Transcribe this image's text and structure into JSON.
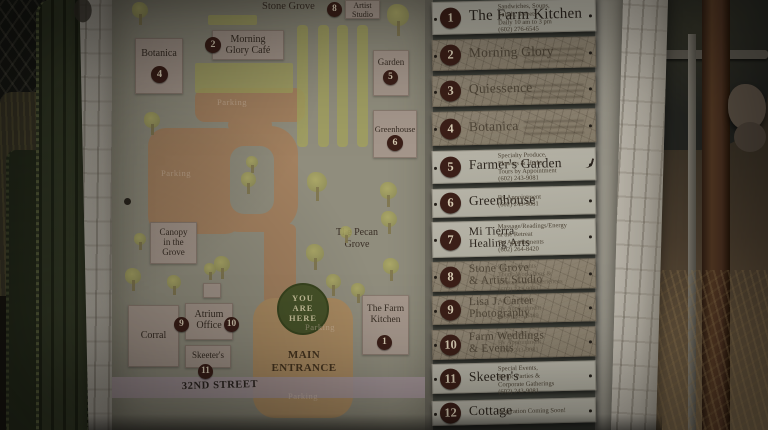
{
  "palette": {
    "badge_brown": "#3b1f18",
    "you_are_here_green": "#475329",
    "road_tan": "#a2805f",
    "entrance_tan": "#a98a61",
    "tree_olive": "#9e9b5c",
    "street_pink": "#a5949a",
    "label_pink": "#a4968b"
  },
  "map": {
    "street_label": "32ND STREET",
    "main_entrance_label": "MAIN ENTRANCE",
    "you_are_here_label": "YOU ARE HERE",
    "stone_grove_label": "Stone Grove",
    "pecan_grove_label": "The Pecan Grove",
    "parking_text": "Parking",
    "parking_labels": [
      {
        "x": 100,
        "y": 97,
        "w": 40
      },
      {
        "x": 44,
        "y": 168,
        "w": 40
      },
      {
        "x": 186,
        "y": 322,
        "w": 44
      },
      {
        "x": 168,
        "y": 391,
        "w": 46
      }
    ],
    "boxes": [
      {
        "id": "artist-studio",
        "lines": [
          "Artist",
          "Studio"
        ],
        "x": 233,
        "y": 0,
        "w": 35,
        "h": 19,
        "fs": 8,
        "pt": 1
      },
      {
        "id": "morning-glory-cafe",
        "lines": [
          "Morning",
          "Glory Café"
        ],
        "x": 100,
        "y": 30,
        "w": 72,
        "h": 30,
        "fs": 10,
        "pt": 3
      },
      {
        "id": "botanica",
        "lines": [
          "Botanica"
        ],
        "x": 23,
        "y": 38,
        "w": 48,
        "h": 56,
        "fs": 10,
        "pt": 9
      },
      {
        "id": "garden",
        "lines": [
          "Garden"
        ],
        "x": 261,
        "y": 50,
        "w": 36,
        "h": 46,
        "fs": 9,
        "pt": 6
      },
      {
        "id": "greenhouse",
        "lines": [
          "Greenhouse"
        ],
        "x": 261,
        "y": 110,
        "w": 44,
        "h": 48,
        "fs": 8.5,
        "pt": 14
      },
      {
        "id": "canopy-in-the-grove",
        "lines": [
          "Canopy",
          "in the",
          "Grove"
        ],
        "x": 38,
        "y": 222,
        "w": 47,
        "h": 42,
        "fs": 9,
        "pt": 4
      },
      {
        "id": "corral",
        "lines": [
          "Corral"
        ],
        "x": 16,
        "y": 305,
        "w": 51,
        "h": 62,
        "fs": 10,
        "pt": 24
      },
      {
        "id": "atrium-office",
        "lines": [
          "Atrium",
          "Office"
        ],
        "x": 73,
        "y": 303,
        "w": 48,
        "h": 37,
        "fs": 10,
        "pt": 5
      },
      {
        "id": "skeeters",
        "lines": [
          "Skeeter's"
        ],
        "x": 73,
        "y": 345,
        "w": 46,
        "h": 23,
        "fs": 9,
        "pt": 4
      },
      {
        "id": "farm-kitchen",
        "lines": [
          "The Farm",
          "Kitchen"
        ],
        "x": 250,
        "y": 295,
        "w": 47,
        "h": 60,
        "fs": 9.5,
        "pt": 8
      },
      {
        "id": "small-structure",
        "lines": [],
        "x": 91,
        "y": 283,
        "w": 18,
        "h": 15,
        "fs": 8,
        "pt": 0
      }
    ],
    "badges": [
      {
        "n": "8",
        "x": 215,
        "y": 2,
        "d": 15
      },
      {
        "n": "2",
        "x": 93,
        "y": 37,
        "d": 16
      },
      {
        "n": "4",
        "x": 39,
        "y": 66,
        "d": 17
      },
      {
        "n": "5",
        "x": 271,
        "y": 70,
        "d": 15
      },
      {
        "n": "6",
        "x": 275,
        "y": 135,
        "d": 16
      },
      {
        "n": "9",
        "x": 62,
        "y": 317,
        "d": 15
      },
      {
        "n": "10",
        "x": 112,
        "y": 317,
        "d": 15
      },
      {
        "n": "11",
        "x": 86,
        "y": 364,
        "d": 15
      },
      {
        "n": "1",
        "x": 265,
        "y": 335,
        "d": 15
      }
    ],
    "garden_rows": [
      185,
      206,
      225,
      245
    ],
    "olive_bars": [
      [
        96,
        15,
        49,
        10
      ],
      [
        83,
        63,
        98,
        30
      ]
    ],
    "trees": [
      [
        28,
        2,
        16
      ],
      [
        286,
        4,
        22
      ],
      [
        40,
        112,
        16
      ],
      [
        140,
        156,
        12
      ],
      [
        136,
        172,
        15
      ],
      [
        205,
        172,
        20
      ],
      [
        276,
        182,
        17
      ],
      [
        277,
        211,
        16
      ],
      [
        28,
        233,
        12
      ],
      [
        234,
        226,
        12
      ],
      [
        203,
        244,
        18
      ],
      [
        279,
        258,
        16
      ],
      [
        110,
        256,
        16
      ],
      [
        21,
        268,
        16
      ],
      [
        62,
        275,
        14
      ],
      [
        98,
        263,
        12
      ],
      [
        221,
        274,
        15
      ],
      [
        246,
        283,
        14
      ]
    ]
  },
  "directory": {
    "items": [
      {
        "number": "1",
        "name_lines": [
          "The Farm Kitchen"
        ],
        "weathered": false,
        "top": 2,
        "h": 33,
        "details": [
          "Sandwiches, Soups,",
          "Salads, Sweets",
          "Daily 10 am to 3 pm",
          "(602) 276-6545"
        ],
        "faint": false
      },
      {
        "number": "2",
        "name_lines": [
          "Morning Glory"
        ],
        "weathered": true,
        "top": 40,
        "h": 31,
        "details": [],
        "faint": true
      },
      {
        "number": "3",
        "name_lines": [
          "Quiessence"
        ],
        "weathered": true,
        "top": 76,
        "h": 31,
        "details": [],
        "faint": true
      },
      {
        "number": "4",
        "name_lines": [
          "Botanica"
        ],
        "weathered": true,
        "top": 112,
        "h": 34,
        "details": [],
        "faint": true
      },
      {
        "number": "5",
        "name_lines": [
          "Farmer's Garden"
        ],
        "weathered": false,
        "top": 151,
        "h": 33,
        "details": [
          "Specialty Produce,",
          "Flowers & Herbs",
          "Tours by Appointment",
          "(602) 243-9081"
        ],
        "faint": false,
        "mark": true
      },
      {
        "number": "6",
        "name_lines": [
          "Greenhouse"
        ],
        "weathered": false,
        "top": 189,
        "h": 29,
        "details": [
          "By Appointment",
          "(602) 243-9081"
        ],
        "faint": false
      },
      {
        "number": "7",
        "name_lines": [
          "Mi Tierra",
          "Healing Arts"
        ],
        "weathered": false,
        "top": 222,
        "h": 36,
        "details": [
          "Massage/Readings/Energy",
          "at the Retreat",
          "By Appointments",
          "(602) 264-8420"
        ],
        "faint": false
      },
      {
        "number": "8",
        "name_lines": [
          "Stone Grove",
          "& Artist Studio"
        ],
        "weathered": true,
        "top": 262,
        "h": 30,
        "details": [
          "Special Events",
          "Tours, Workshops &",
          "Educational Experiences",
          "(602) 243-9081"
        ],
        "faint": true
      },
      {
        "number": "9",
        "name_lines": [
          "Lisa J. Carter",
          "Photography"
        ],
        "weathered": true,
        "top": 296,
        "h": 29,
        "details": [
          "Atrium Office",
          "By Appointment",
          "(480) 286-0449"
        ],
        "faint": true
      },
      {
        "number": "10",
        "name_lines": [
          "Farm Weddings",
          "& Events"
        ],
        "weathered": true,
        "top": 330,
        "h": 30,
        "details": [
          "Atrium Office",
          "By Appointment",
          "(602) 243-9081"
        ],
        "faint": true
      },
      {
        "number": "11",
        "name_lines": [
          "Skeeter's"
        ],
        "weathered": false,
        "top": 364,
        "h": 30,
        "details": [
          "Special Events,",
          "Picnic Parties &",
          "Corporate Gatherings",
          "(602) 243-9081"
        ],
        "faint": false
      },
      {
        "number": "12",
        "name_lines": [
          "Cottage"
        ],
        "weathered": false,
        "top": 401,
        "h": 25,
        "details": [
          "Inspiration Coming Soon!"
        ],
        "faint": false
      }
    ]
  }
}
